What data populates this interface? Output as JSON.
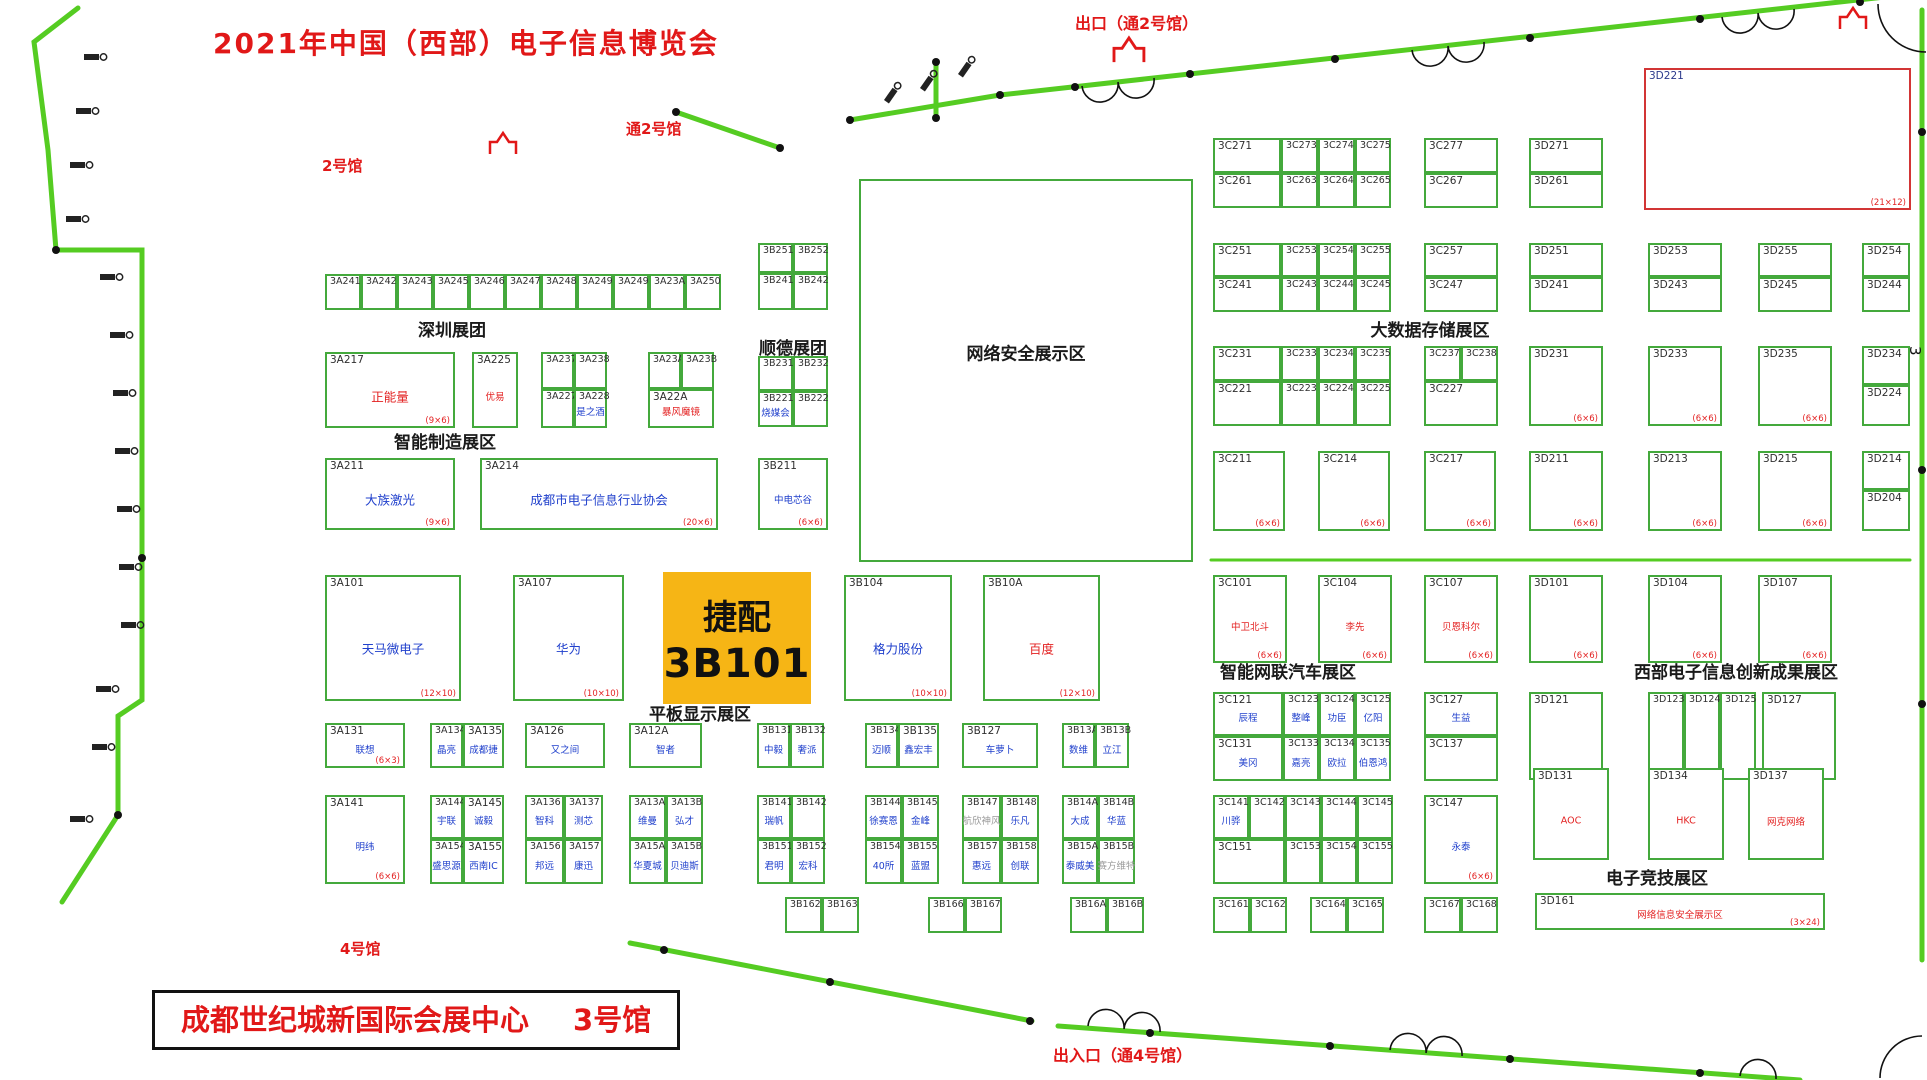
{
  "header": {
    "title": "2021年中国（西部）电子信息博览会"
  },
  "venue": {
    "name": "成都世纪城新国际会展中心",
    "hall": "3号馆"
  },
  "directions": {
    "hall2": "2号馆",
    "to_hall2": "通2号馆",
    "exit_top": "出口（通2号馆）",
    "hall4": "4号馆",
    "entrance_bottom": "出入口（通4号馆）",
    "gate_mark": "3"
  },
  "colors": {
    "wall_green": "#55cc22",
    "booth_border_green": "#44a93c",
    "name_blue": "#2040cc",
    "accent_red": "#e32222",
    "highlight_yellow": "#f6b515"
  },
  "zones": [
    {
      "t": "深圳展团",
      "x": 452,
      "y": 316
    },
    {
      "t": "顺德展团",
      "x": 793,
      "y": 334
    },
    {
      "t": "智能制造展区",
      "x": 445,
      "y": 428
    },
    {
      "t": "平板显示展区",
      "x": 700,
      "y": 700
    },
    {
      "t": "大数据存储展区",
      "x": 1430,
      "y": 316
    },
    {
      "t": "智能网联汽车展区",
      "x": 1288,
      "y": 658
    },
    {
      "t": "西部电子信息创新成果展区",
      "x": 1736,
      "y": 658
    },
    {
      "t": "电子竞技展区",
      "x": 1657,
      "y": 864
    }
  ],
  "booths": [
    [
      "3A241",
      325,
      274,
      36,
      36
    ],
    [
      "3A242",
      361,
      274,
      36,
      36
    ],
    [
      "3A243",
      397,
      274,
      36,
      36
    ],
    [
      "3A245",
      433,
      274,
      36,
      36
    ],
    [
      "3A246",
      469,
      274,
      36,
      36
    ],
    [
      "3A247",
      505,
      274,
      36,
      36
    ],
    [
      "3A248",
      541,
      274,
      36,
      36
    ],
    [
      "3A249",
      577,
      274,
      36,
      36
    ],
    [
      "3A249",
      613,
      274,
      36,
      36
    ],
    [
      "3A23A",
      649,
      274,
      36,
      36
    ],
    [
      "3A250",
      685,
      274,
      36,
      36
    ],
    [
      "3B251",
      758,
      243,
      35,
      30
    ],
    [
      "3B252",
      793,
      243,
      35,
      30
    ],
    [
      "3B241",
      758,
      273,
      35,
      37
    ],
    [
      "3B242",
      793,
      273,
      35,
      37
    ],
    [
      "3B231",
      758,
      356,
      35,
      35
    ],
    [
      "3B232",
      793,
      356,
      35,
      35
    ],
    [
      "3B221",
      758,
      391,
      35,
      36,
      "烧媒会",
      "b"
    ],
    [
      "3B222",
      793,
      391,
      35,
      36
    ],
    [
      "3A217",
      325,
      352,
      130,
      76,
      "正能量",
      "r",
      "(9×6)"
    ],
    [
      "3A225",
      472,
      352,
      46,
      76,
      "优易",
      "r"
    ],
    [
      "3A237",
      541,
      352,
      33,
      37
    ],
    [
      "3A238",
      574,
      352,
      33,
      37
    ],
    [
      "3A227",
      541,
      389,
      33,
      39
    ],
    [
      "3A228",
      574,
      389,
      33,
      39,
      "是之酒",
      "b"
    ],
    [
      "3A23A",
      648,
      352,
      33,
      37
    ],
    [
      "3A23B",
      681,
      352,
      33,
      37
    ],
    [
      "3A22A",
      648,
      389,
      66,
      39,
      "暴风魔镜",
      "r"
    ],
    [
      "3A211",
      325,
      458,
      130,
      72,
      "大族激光",
      "b",
      "(9×6)"
    ],
    [
      "3A214",
      480,
      458,
      238,
      72,
      "成都市电子信息行业协会",
      "b",
      "(20×6)"
    ],
    [
      "3B211",
      758,
      458,
      70,
      72,
      "中电芯谷",
      "b",
      "(6×6)"
    ],
    [
      "3A101",
      325,
      575,
      136,
      126,
      "天马微电子",
      "b",
      "(12×10)"
    ],
    [
      "3A107",
      513,
      575,
      111,
      126,
      "华为",
      "b",
      "(10×10)"
    ],
    [
      "3B101",
      663,
      572,
      148,
      132,
      "捷配",
      null,
      null,
      "hl"
    ],
    [
      "3B104",
      844,
      575,
      108,
      126,
      "格力股份",
      "b",
      "(10×10)"
    ],
    [
      "3B10A",
      983,
      575,
      117,
      126,
      "百度",
      "r",
      "(12×10)"
    ],
    [
      "",
      859,
      179,
      334,
      383,
      "网络安全展示区",
      "k"
    ],
    [
      "3A131",
      325,
      723,
      80,
      45,
      "联想",
      "b",
      "(6×3)"
    ],
    [
      "3A134",
      430,
      723,
      33,
      45,
      "晶亮",
      "b"
    ],
    [
      "3A135",
      463,
      723,
      41,
      45,
      "成都捷",
      "b"
    ],
    [
      "3A126",
      525,
      723,
      80,
      45,
      "又之间",
      "b"
    ],
    [
      "3A12A",
      629,
      723,
      73,
      45,
      "智者",
      "b"
    ],
    [
      "3B131",
      757,
      723,
      33,
      45,
      "中毅",
      "b"
    ],
    [
      "3B132",
      790,
      723,
      34,
      45,
      "奢派",
      "b"
    ],
    [
      "3B134",
      865,
      723,
      33,
      45,
      "迈顺",
      "b"
    ],
    [
      "3B135",
      898,
      723,
      41,
      45,
      "鑫宏丰",
      "b"
    ],
    [
      "3B127",
      962,
      723,
      76,
      45,
      "车萝卜",
      "b"
    ],
    [
      "3B13A",
      1062,
      723,
      33,
      45,
      "数维",
      "b"
    ],
    [
      "3B13B",
      1095,
      723,
      34,
      45,
      "立江",
      "b"
    ],
    [
      "3A141",
      325,
      795,
      80,
      89,
      "明纬",
      "b",
      "(6×6)"
    ],
    [
      "3A144",
      430,
      795,
      33,
      44,
      "宇联",
      "b"
    ],
    [
      "3A145",
      463,
      795,
      41,
      44,
      "诚毅",
      "b"
    ],
    [
      "3A154",
      430,
      839,
      33,
      45,
      "盛思源",
      "b"
    ],
    [
      "3A155",
      463,
      839,
      41,
      45,
      "西南IC",
      "b"
    ],
    [
      "3A136",
      525,
      795,
      39,
      44,
      "智科",
      "b"
    ],
    [
      "3A137",
      564,
      795,
      39,
      44,
      "测芯",
      "b"
    ],
    [
      "3A156",
      525,
      839,
      39,
      45,
      "邦远",
      "b"
    ],
    [
      "3A157",
      564,
      839,
      39,
      45,
      "康迅",
      "b"
    ],
    [
      "3A13A",
      629,
      795,
      37,
      44,
      "维曼",
      "b"
    ],
    [
      "3A13B",
      666,
      795,
      37,
      44,
      "弘才",
      "b"
    ],
    [
      "3A15A",
      629,
      839,
      37,
      45,
      "华夏城",
      "b"
    ],
    [
      "3A15B",
      666,
      839,
      37,
      45,
      "贝迪斯",
      "b"
    ],
    [
      "3B141",
      757,
      795,
      34,
      44,
      "瑞帆",
      "b"
    ],
    [
      "3B142",
      791,
      795,
      34,
      44
    ],
    [
      "3B151",
      757,
      839,
      34,
      45,
      "君明",
      "b"
    ],
    [
      "3B152",
      791,
      839,
      34,
      45,
      "宏科",
      "b"
    ],
    [
      "3B144",
      865,
      795,
      37,
      44,
      "徐赛恩",
      "b"
    ],
    [
      "3B145",
      902,
      795,
      37,
      44,
      "金峰",
      "b"
    ],
    [
      "3B154",
      865,
      839,
      37,
      45,
      "40所",
      "b"
    ],
    [
      "3B155",
      902,
      839,
      37,
      45,
      "蓝盟",
      "b"
    ],
    [
      "3B147",
      962,
      795,
      39,
      44,
      "航欣神风",
      "g"
    ],
    [
      "3B148",
      1001,
      795,
      38,
      44,
      "乐凡",
      "b"
    ],
    [
      "3B157",
      962,
      839,
      39,
      45,
      "惠远",
      "b"
    ],
    [
      "3B158",
      1001,
      839,
      38,
      45,
      "创联",
      "b"
    ],
    [
      "3B14A",
      1062,
      795,
      36,
      44,
      "大成",
      "b"
    ],
    [
      "3B14B",
      1098,
      795,
      37,
      44,
      "华蓝",
      "b"
    ],
    [
      "3B15A",
      1062,
      839,
      36,
      45,
      "泰威美",
      "b"
    ],
    [
      "3B15B",
      1098,
      839,
      37,
      45,
      "赛方维特",
      "g"
    ],
    [
      "3B162",
      785,
      897,
      37,
      36
    ],
    [
      "3B163",
      822,
      897,
      37,
      36
    ],
    [
      "3B166",
      928,
      897,
      37,
      36
    ],
    [
      "3B167",
      965,
      897,
      37,
      36
    ],
    [
      "3B16A",
      1070,
      897,
      37,
      36
    ],
    [
      "3B16B",
      1107,
      897,
      37,
      36
    ],
    [
      "3C271",
      1213,
      138,
      68,
      35
    ],
    [
      "3C273",
      1281,
      138,
      37,
      35
    ],
    [
      "3C274",
      1318,
      138,
      37,
      35
    ],
    [
      "3C275",
      1355,
      138,
      36,
      35
    ],
    [
      "3C261",
      1213,
      173,
      68,
      35
    ],
    [
      "3C263",
      1281,
      173,
      37,
      35
    ],
    [
      "3C264",
      1318,
      173,
      37,
      35
    ],
    [
      "3C265",
      1355,
      173,
      36,
      35
    ],
    [
      "3C277",
      1424,
      138,
      74,
      35
    ],
    [
      "3C267",
      1424,
      173,
      74,
      35
    ],
    [
      "3D271",
      1529,
      138,
      74,
      35
    ],
    [
      "3D261",
      1529,
      173,
      74,
      35
    ],
    [
      "3D221",
      1644,
      68,
      267,
      142,
      null,
      null,
      "(21×12)",
      "rb"
    ],
    [
      "3C251",
      1213,
      243,
      68,
      34
    ],
    [
      "3C253",
      1281,
      243,
      37,
      34
    ],
    [
      "3C254",
      1318,
      243,
      37,
      34
    ],
    [
      "3C255",
      1355,
      243,
      36,
      34
    ],
    [
      "3C241",
      1213,
      277,
      68,
      35
    ],
    [
      "3C243",
      1281,
      277,
      37,
      35
    ],
    [
      "3C244",
      1318,
      277,
      37,
      35
    ],
    [
      "3C245",
      1355,
      277,
      36,
      35
    ],
    [
      "3C257",
      1424,
      243,
      74,
      34
    ],
    [
      "3C247",
      1424,
      277,
      74,
      35
    ],
    [
      "3D251",
      1529,
      243,
      74,
      34
    ],
    [
      "3D241",
      1529,
      277,
      74,
      35
    ],
    [
      "3D253",
      1648,
      243,
      74,
      34
    ],
    [
      "3D243",
      1648,
      277,
      74,
      35
    ],
    [
      "3D255",
      1758,
      243,
      74,
      34
    ],
    [
      "3D245",
      1758,
      277,
      74,
      35
    ],
    [
      "3D254",
      1862,
      243,
      48,
      34
    ],
    [
      "3D244",
      1862,
      277,
      48,
      35
    ],
    [
      "3C231",
      1213,
      346,
      68,
      35
    ],
    [
      "3C233",
      1281,
      346,
      37,
      35
    ],
    [
      "3C234",
      1318,
      346,
      37,
      35
    ],
    [
      "3C235",
      1355,
      346,
      36,
      35
    ],
    [
      "3C221",
      1213,
      381,
      68,
      45
    ],
    [
      "3C223",
      1281,
      381,
      37,
      45
    ],
    [
      "3C224",
      1318,
      381,
      37,
      45
    ],
    [
      "3C225",
      1355,
      381,
      36,
      45
    ],
    [
      "3C237",
      1424,
      346,
      37,
      35
    ],
    [
      "3C238",
      1461,
      346,
      37,
      35
    ],
    [
      "3C227",
      1424,
      381,
      74,
      45
    ],
    [
      "3D231",
      1529,
      346,
      74,
      80,
      null,
      null,
      "(6×6)"
    ],
    [
      "3D233",
      1648,
      346,
      74,
      80,
      null,
      null,
      "(6×6)"
    ],
    [
      "3D235",
      1758,
      346,
      74,
      80,
      null,
      null,
      "(6×6)"
    ],
    [
      "3D234",
      1862,
      346,
      48,
      39
    ],
    [
      "3D224",
      1862,
      385,
      48,
      41
    ],
    [
      "3C211",
      1213,
      451,
      72,
      80,
      null,
      null,
      "(6×6)"
    ],
    [
      "3C214",
      1318,
      451,
      72,
      80,
      null,
      null,
      "(6×6)"
    ],
    [
      "3C217",
      1424,
      451,
      72,
      80,
      null,
      null,
      "(6×6)"
    ],
    [
      "3D211",
      1529,
      451,
      74,
      80,
      null,
      null,
      "(6×6)"
    ],
    [
      "3D213",
      1648,
      451,
      74,
      80,
      null,
      null,
      "(6×6)"
    ],
    [
      "3D215",
      1758,
      451,
      74,
      80,
      null,
      null,
      "(6×6)"
    ],
    [
      "3D214",
      1862,
      451,
      48,
      39
    ],
    [
      "3D204",
      1862,
      490,
      48,
      41
    ],
    [
      "3C101",
      1213,
      575,
      74,
      88,
      "中卫北斗",
      "r",
      "(6×6)"
    ],
    [
      "3C104",
      1318,
      575,
      74,
      88,
      "李先",
      "r",
      "(6×6)"
    ],
    [
      "3C107",
      1424,
      575,
      74,
      88,
      "贝恩科尔",
      "r",
      "(6×6)"
    ],
    [
      "3D101",
      1529,
      575,
      74,
      88,
      null,
      null,
      "(6×6)"
    ],
    [
      "3D104",
      1648,
      575,
      74,
      88,
      null,
      null,
      "(6×6)"
    ],
    [
      "3D107",
      1758,
      575,
      74,
      88,
      null,
      null,
      "(6×6)"
    ],
    [
      "3C121",
      1213,
      692,
      70,
      44,
      "辰程",
      "b"
    ],
    [
      "3C123",
      1283,
      692,
      36,
      44,
      "整峰",
      "b"
    ],
    [
      "3C124",
      1319,
      692,
      36,
      44,
      "功臣",
      "b"
    ],
    [
      "3C125",
      1355,
      692,
      36,
      44,
      "亿阳",
      "b"
    ],
    [
      "3C131",
      1213,
      736,
      70,
      45,
      "美冈",
      "b"
    ],
    [
      "3C133",
      1283,
      736,
      36,
      45,
      "嘉亮",
      "b"
    ],
    [
      "3C134",
      1319,
      736,
      36,
      45,
      "欧拉",
      "b"
    ],
    [
      "3C135",
      1355,
      736,
      36,
      45,
      "伯恩鸿",
      "b"
    ],
    [
      "3C127",
      1424,
      692,
      74,
      44,
      "生益",
      "b"
    ],
    [
      "3C137",
      1424,
      736,
      74,
      45
    ],
    [
      "3D121",
      1529,
      692,
      74,
      88
    ],
    [
      "3D123",
      1648,
      692,
      36,
      88
    ],
    [
      "3D124",
      1684,
      692,
      36,
      88
    ],
    [
      "3D125",
      1720,
      692,
      36,
      88
    ],
    [
      "3D127",
      1762,
      692,
      74,
      88
    ],
    [
      "3C141",
      1213,
      795,
      36,
      44,
      "川骅",
      "b"
    ],
    [
      "3C142",
      1249,
      795,
      36,
      44
    ],
    [
      "3C143",
      1285,
      795,
      36,
      44
    ],
    [
      "3C144",
      1321,
      795,
      36,
      44
    ],
    [
      "3C145",
      1357,
      795,
      36,
      44
    ],
    [
      "3C151",
      1213,
      839,
      72,
      45
    ],
    [
      "3C153",
      1285,
      839,
      36,
      45
    ],
    [
      "3C154",
      1321,
      839,
      36,
      45
    ],
    [
      "3C155",
      1357,
      839,
      36,
      45
    ],
    [
      "3C147",
      1424,
      795,
      74,
      89,
      "永泰",
      "b",
      "(6×6)"
    ],
    [
      "3D131",
      1533,
      768,
      76,
      92,
      "AOC",
      "r"
    ],
    [
      "3D134",
      1648,
      768,
      76,
      92,
      "HKC",
      "r"
    ],
    [
      "3D137",
      1748,
      768,
      76,
      92,
      "网克网络",
      "r"
    ],
    [
      "3C161",
      1213,
      897,
      37,
      36
    ],
    [
      "3C162",
      1250,
      897,
      37,
      36
    ],
    [
      "3C164",
      1310,
      897,
      37,
      36
    ],
    [
      "3C165",
      1347,
      897,
      37,
      36
    ],
    [
      "3C167",
      1424,
      897,
      37,
      36
    ],
    [
      "3C168",
      1461,
      897,
      37,
      36
    ],
    [
      "3D161",
      1535,
      893,
      290,
      37,
      "网络信息安全展示区",
      "r",
      "(3×24)"
    ]
  ]
}
